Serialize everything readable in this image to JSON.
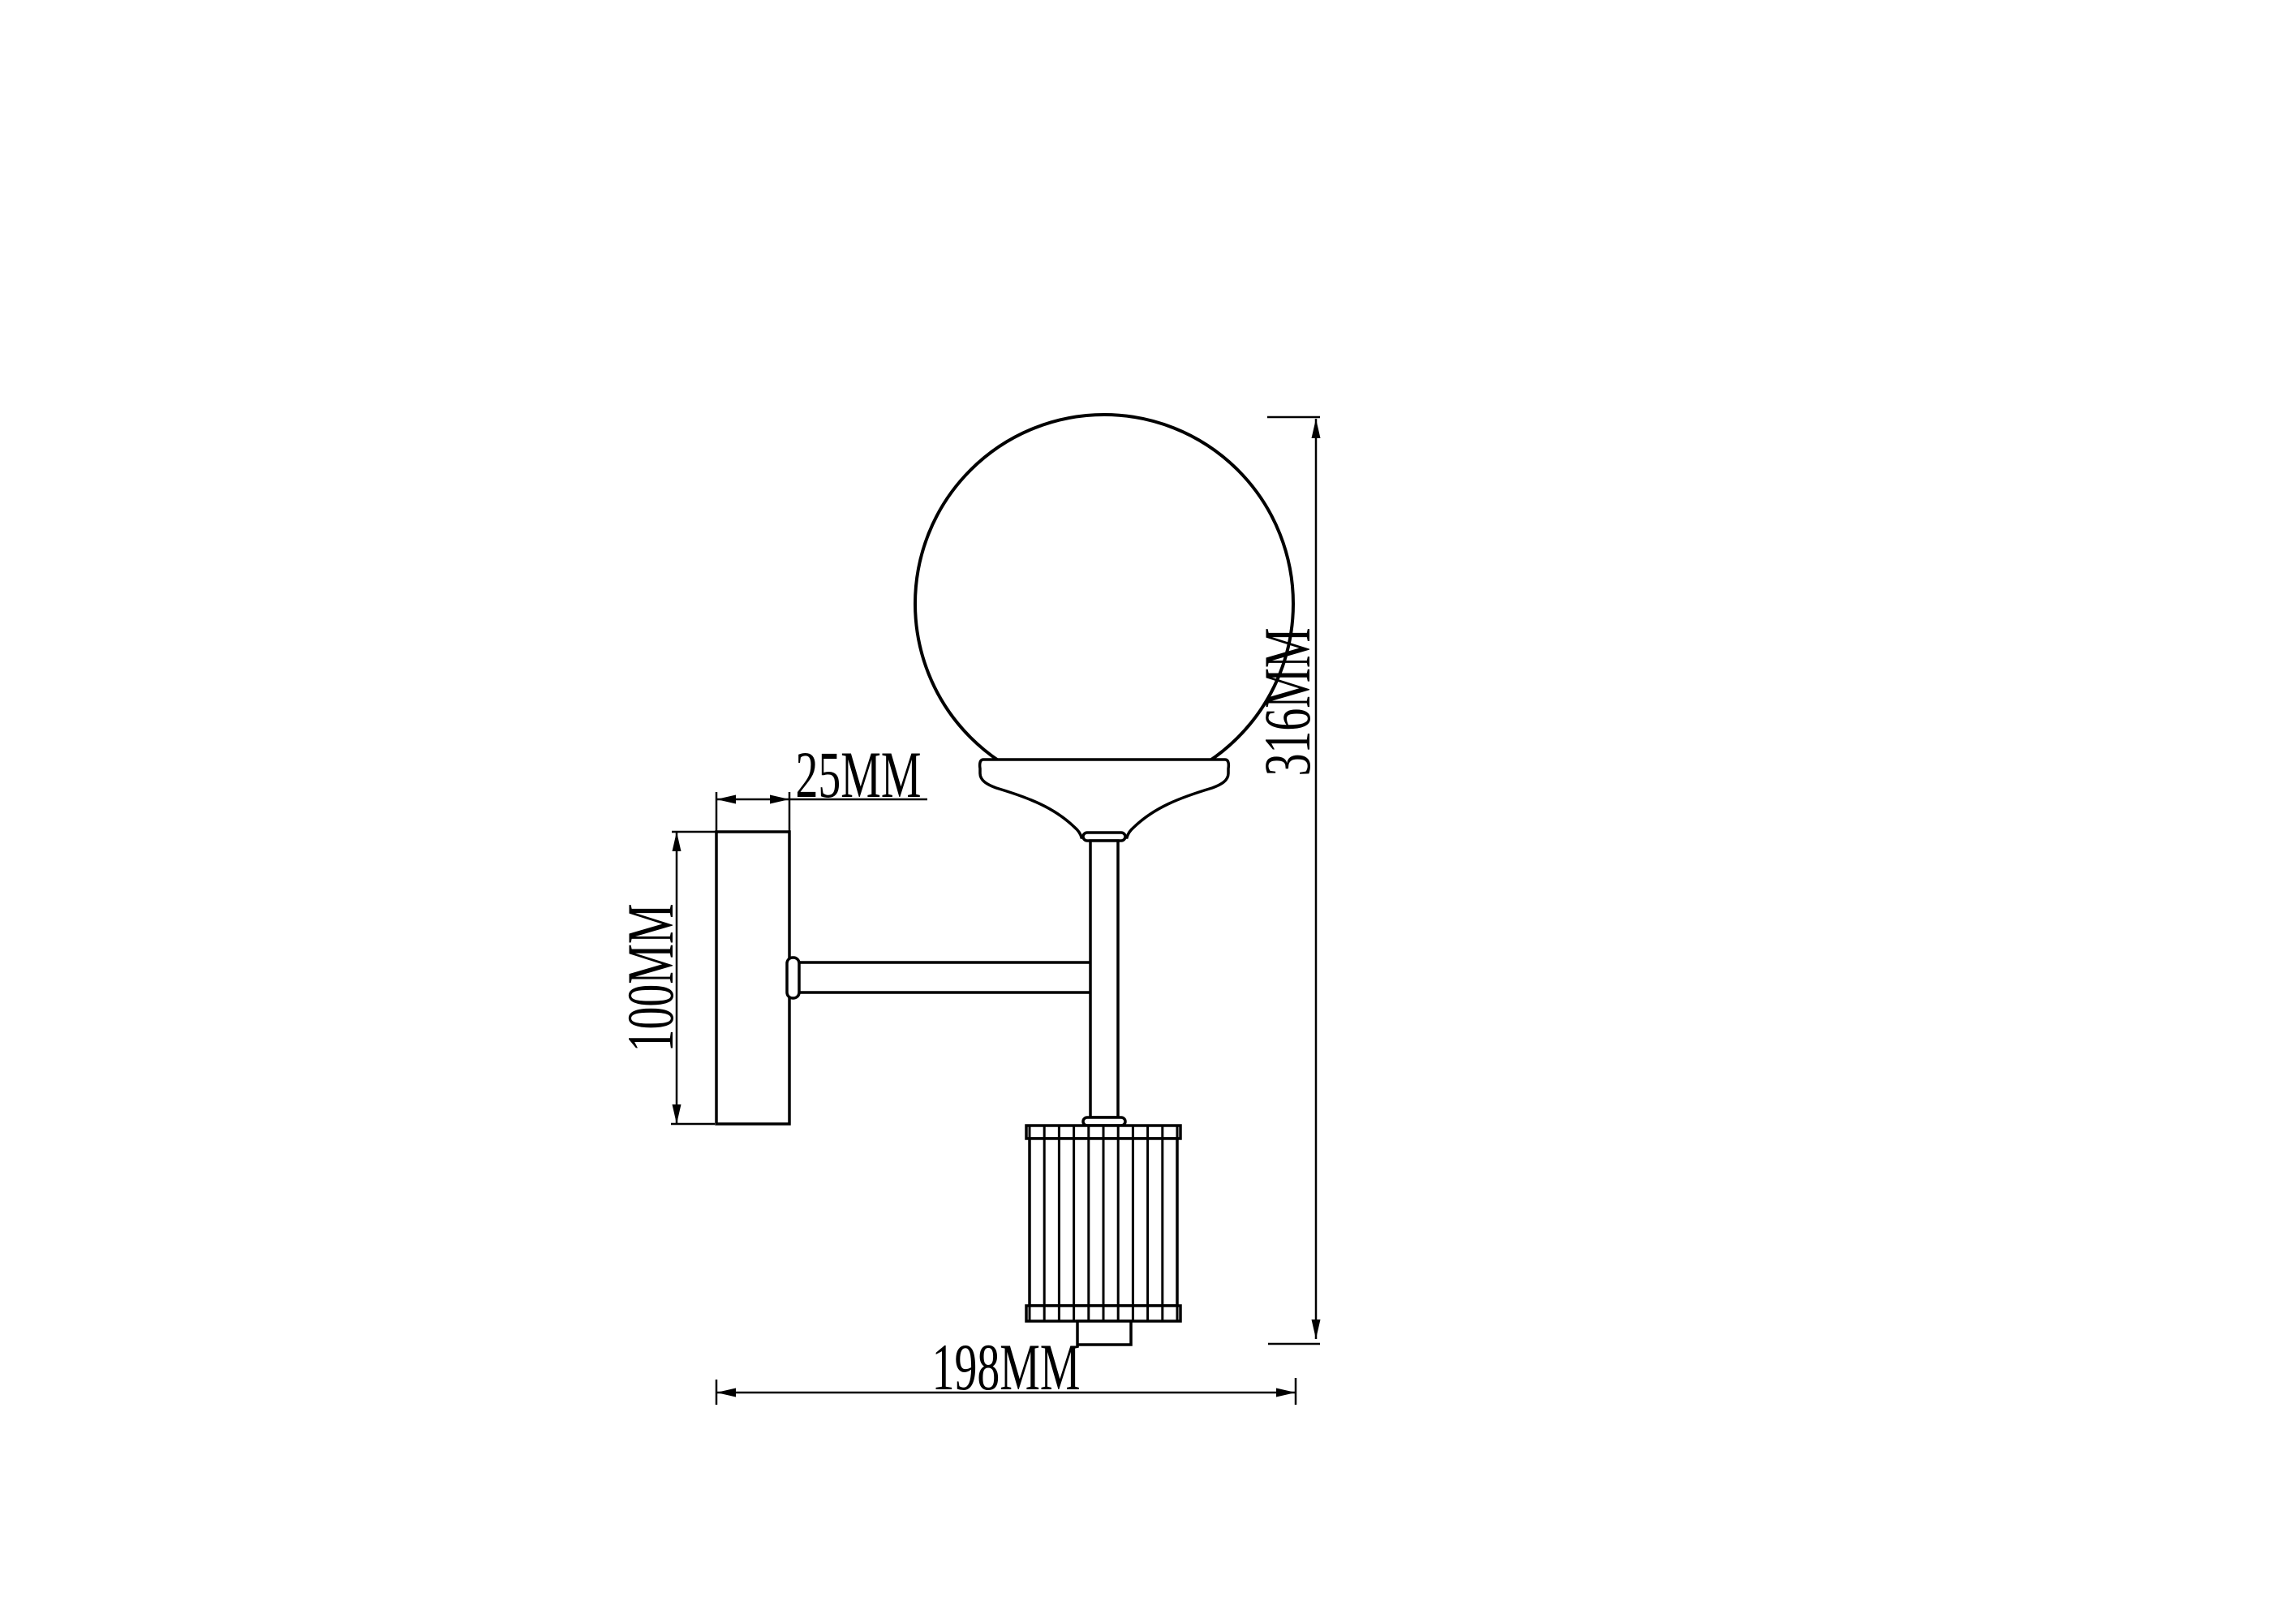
{
  "drawing": {
    "type": "wall-sconce-dimension-drawing",
    "background_color": "#ffffff",
    "line_color": "#000000",
    "dimensions": {
      "plate_depth": {
        "label": "25MM"
      },
      "plate_height": {
        "label": "100MM"
      },
      "overall_height": {
        "label": "316MM"
      },
      "overall_depth": {
        "label": "198MM"
      }
    }
  }
}
